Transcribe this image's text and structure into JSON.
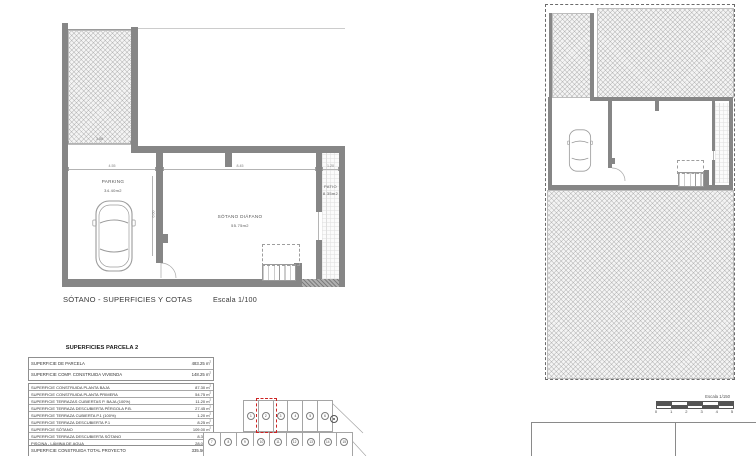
{
  "basement_plan": {
    "title": "SÓTANO - SUPERFICIES Y COTAS",
    "scale_label": "Escala 1/100",
    "rooms": {
      "parking": {
        "name": "PARKING",
        "area": "34.40m2"
      },
      "sotano_diafano": {
        "name": "SÓTANO DIÁFANO",
        "area": "55.75m2"
      },
      "patio": {
        "name": "PATIO",
        "area": "8.35m2"
      }
    },
    "dimensions": {
      "ramp_width": "3.88",
      "parking_width": "4.55",
      "sotano_width": "8.45",
      "patio_width": "1.20",
      "sotano_depth": "6.60"
    }
  },
  "site_plan": {
    "scale_label": "Escala 1/150",
    "scale_ticks": [
      "0",
      "1",
      "2",
      "3",
      "4",
      "5"
    ]
  },
  "surfaces_table": {
    "title": "SUPERFICIES PARCELA 2",
    "unit": "m²",
    "parcel_group": [
      {
        "label": "SUPERFICIE DE PARCELA",
        "value": "483.25"
      },
      {
        "label": "SUPERFICIE COMP. CONSTRUIDA VIVIENDA",
        "value": "148.25"
      }
    ],
    "detail_group": [
      {
        "label": "SUPERFICIE CONSTRUIDA PLANTA BAJA",
        "value": "87.30"
      },
      {
        "label": "SUPERFICIE CONSTRUIDA PLANTA PRIMERA",
        "value": "54.75"
      },
      {
        "label": "SUPERFICIE TERRAZAS CUBIERTAS P. BAJA (100%)",
        "value": "11.20"
      },
      {
        "label": "SUPERFICIE TERRAZA DESCUBIERTA PÉRGOLA P.B.",
        "value": "27.45"
      },
      {
        "label": "SUPERFICIE TERRAZA CUBIERTA P.1 (100%)",
        "value": "1.20"
      },
      {
        "label": "SUPERFICIE TERRAZA DESCUBIERTA P.1",
        "value": "8.25"
      },
      {
        "label": "SUPERFICIE SÓTANO",
        "value": "109.00"
      },
      {
        "label": "SUPERFICIE TERRAZA DESCUBIERTA SÓTANO",
        "value": "8.35"
      },
      {
        "label": "PISCINA - LÁMINA DE AGUA",
        "value": "28.00"
      }
    ],
    "total_group": [
      {
        "label": "SUPERFICIE CONSTRUIDA TOTAL PROYECTO",
        "value": "335.50"
      }
    ]
  },
  "key_plan": {
    "highlighted_parcel": "2",
    "highlight_color": "#cc2222",
    "top_row_parcels": [
      "1",
      "2",
      "3",
      "4",
      "5",
      "6"
    ],
    "bottom_row_parcels": [
      "7",
      "8",
      "9",
      "10",
      "11",
      "12",
      "13",
      "14",
      "15"
    ]
  }
}
